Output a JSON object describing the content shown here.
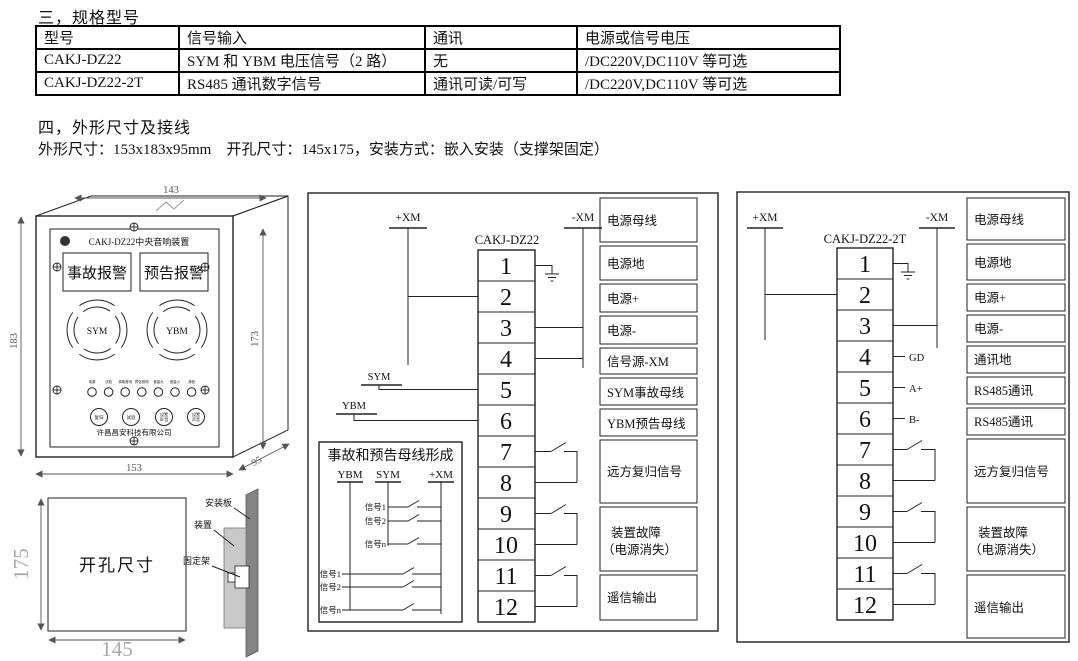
{
  "sections": {
    "spec_heading": "三，规格型号",
    "outline_heading": "四，外形尺寸及接线",
    "outline_subtitle": "外形尺寸：153x183x95mm　开孔尺寸：145x175，安装方式：嵌入安装（支撑架固定）"
  },
  "spec_table": {
    "headers": [
      "型号",
      "信号输入",
      "通讯",
      "电源或信号电压"
    ],
    "rows": [
      [
        "CAKJ-DZ22",
        "SYM 和 YBM 电压信号（2 路）",
        "无",
        "/DC220V,DC110V 等可选"
      ],
      [
        "CAKJ-DZ22-2T",
        "RS485 通讯数字信号",
        "通讯可读/可写",
        "/DC220V,DC110V 等可选"
      ]
    ]
  },
  "front_panel": {
    "title": "CAKJ-DZ22中央音响装置",
    "alarm_left": "事故报警",
    "alarm_right": "预告报警",
    "speaker_left": "SYM",
    "speaker_right": "YBM",
    "led_labels": [
      "电源",
      "试验",
      "事故音响",
      "预告音响",
      "音量大",
      "音量小",
      "静音"
    ],
    "buttons": [
      [
        "复归"
      ],
      [
        "试验"
      ],
      [
        "设置",
        "声/音"
      ],
      [
        "设置",
        "声音"
      ]
    ],
    "company": "许昌昌安科技有限公司",
    "dims": {
      "top": "143",
      "left": "183",
      "right": "173",
      "bottom": "153",
      "depth": "95"
    }
  },
  "cutout": {
    "label": "开孔尺寸",
    "height": "175",
    "width": "145",
    "mount_plate": "安装板",
    "device": "装置",
    "bracket": "固定架"
  },
  "dz22": {
    "name": "CAKJ-DZ22",
    "bus_pos": "+XM",
    "bus_neg": "-XM",
    "sym_bus": "SYM",
    "ybm_bus": "YBM",
    "terminals": [
      "1",
      "2",
      "3",
      "4",
      "5",
      "6",
      "7",
      "8",
      "9",
      "10",
      "11",
      "12"
    ],
    "rows": [
      [
        "电源母线"
      ],
      [
        "电源地"
      ],
      [
        "电源+"
      ],
      [
        "电源-"
      ],
      [
        "信号源-XM"
      ],
      [
        "SYM事故母线"
      ],
      [
        "YBM预告母线"
      ],
      [
        "远方复归信号"
      ],
      [
        "装置故障",
        "（电源消失）"
      ],
      [
        "遥信输出"
      ]
    ],
    "inner": {
      "title": "事故和预告母线形成",
      "cols": [
        "YBM",
        "SYM",
        "+XM"
      ],
      "upper": [
        "信号1",
        "信号2",
        "信号n"
      ],
      "lower": [
        "信号1",
        "信号2",
        "信号n"
      ]
    }
  },
  "dz22_2t": {
    "name": "CAKJ-DZ22-2T",
    "bus_pos": "+XM",
    "bus_neg": "-XM",
    "pins": [
      "GD",
      "A+",
      "B-"
    ],
    "terminals": [
      "1",
      "2",
      "3",
      "4",
      "5",
      "6",
      "7",
      "8",
      "9",
      "10",
      "11",
      "12"
    ],
    "rows": [
      [
        "电源母线"
      ],
      [
        "电源地"
      ],
      [
        "电源+"
      ],
      [
        "电源-"
      ],
      [
        "通讯地"
      ],
      [
        "RS485通讯"
      ],
      [
        "RS485通讯"
      ],
      [
        "远方复归信号"
      ],
      [
        "装置故障",
        "（电源消失）"
      ],
      [
        "遥信输出"
      ]
    ]
  }
}
